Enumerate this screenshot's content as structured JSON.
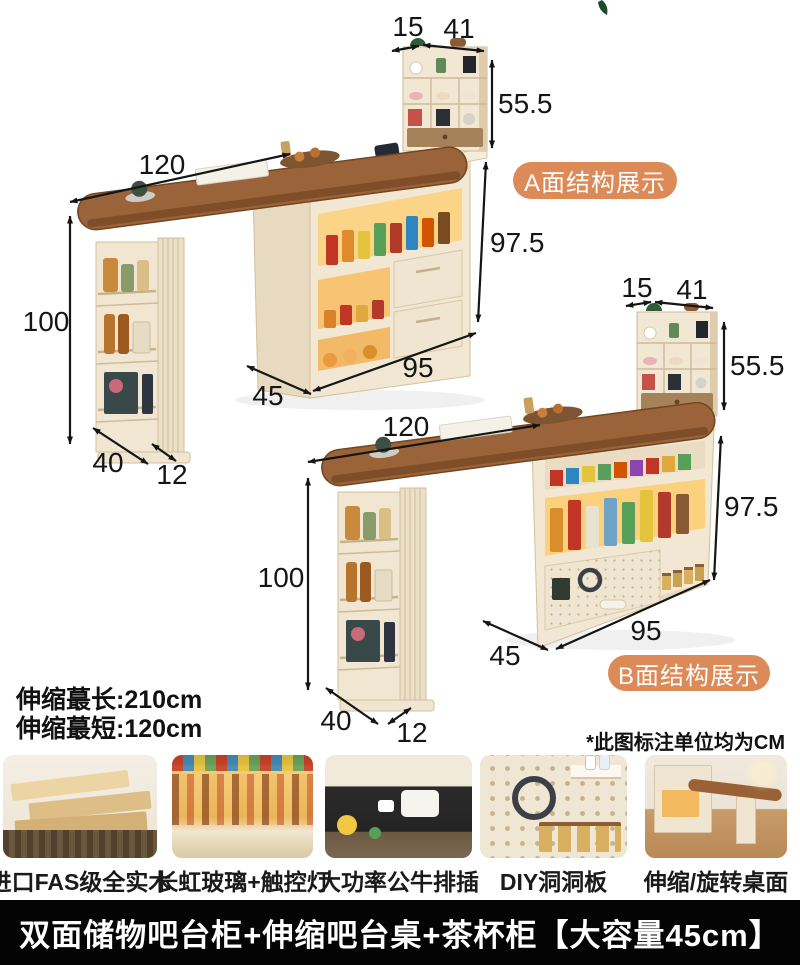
{
  "diagram_a": {
    "badge_label": "A面结构展示",
    "dims": {
      "hutch_side": "15",
      "hutch_width": "41",
      "hutch_height": "55.5",
      "table_length": "120",
      "table_height": "100",
      "cabinet_height": "97.5",
      "cabinet_length": "95",
      "cabinet_depth": "45",
      "leg_depth": "40",
      "leg_width": "12"
    }
  },
  "diagram_b": {
    "badge_label": "B面结构展示",
    "dims": {
      "hutch_side": "15",
      "hutch_width": "41",
      "hutch_height": "55.5",
      "table_length": "120",
      "table_height": "100",
      "cabinet_height": "97.5",
      "cabinet_length": "95",
      "cabinet_depth": "45",
      "leg_depth": "40",
      "leg_width": "12"
    }
  },
  "notes": {
    "extend_max": "伸缩蕞长:210cm",
    "extend_min": "伸缩蕞短:120cm",
    "unit": "*此图标注单位均为CM"
  },
  "features": [
    {
      "caption": "进口FAS级全实木"
    },
    {
      "caption": "长虹玻璃+触控灯"
    },
    {
      "caption": "大功率公牛排插"
    },
    {
      "caption": "DIY洞洞板"
    },
    {
      "caption": "伸缩/旋转桌面"
    }
  ],
  "footer": {
    "title": "双面储物吧台柜+伸缩吧台桌+茶杯柜【大容量45cm】"
  },
  "colors": {
    "accent_badge": "#DC8A58",
    "footer_bg": "#040404",
    "footer_text": "#FFFFFF",
    "dimension_text": "#151515",
    "wood_top": "#9A6137",
    "cabinet_cream": "#F1E7D3",
    "glow_shelf": "#FBD17E"
  }
}
